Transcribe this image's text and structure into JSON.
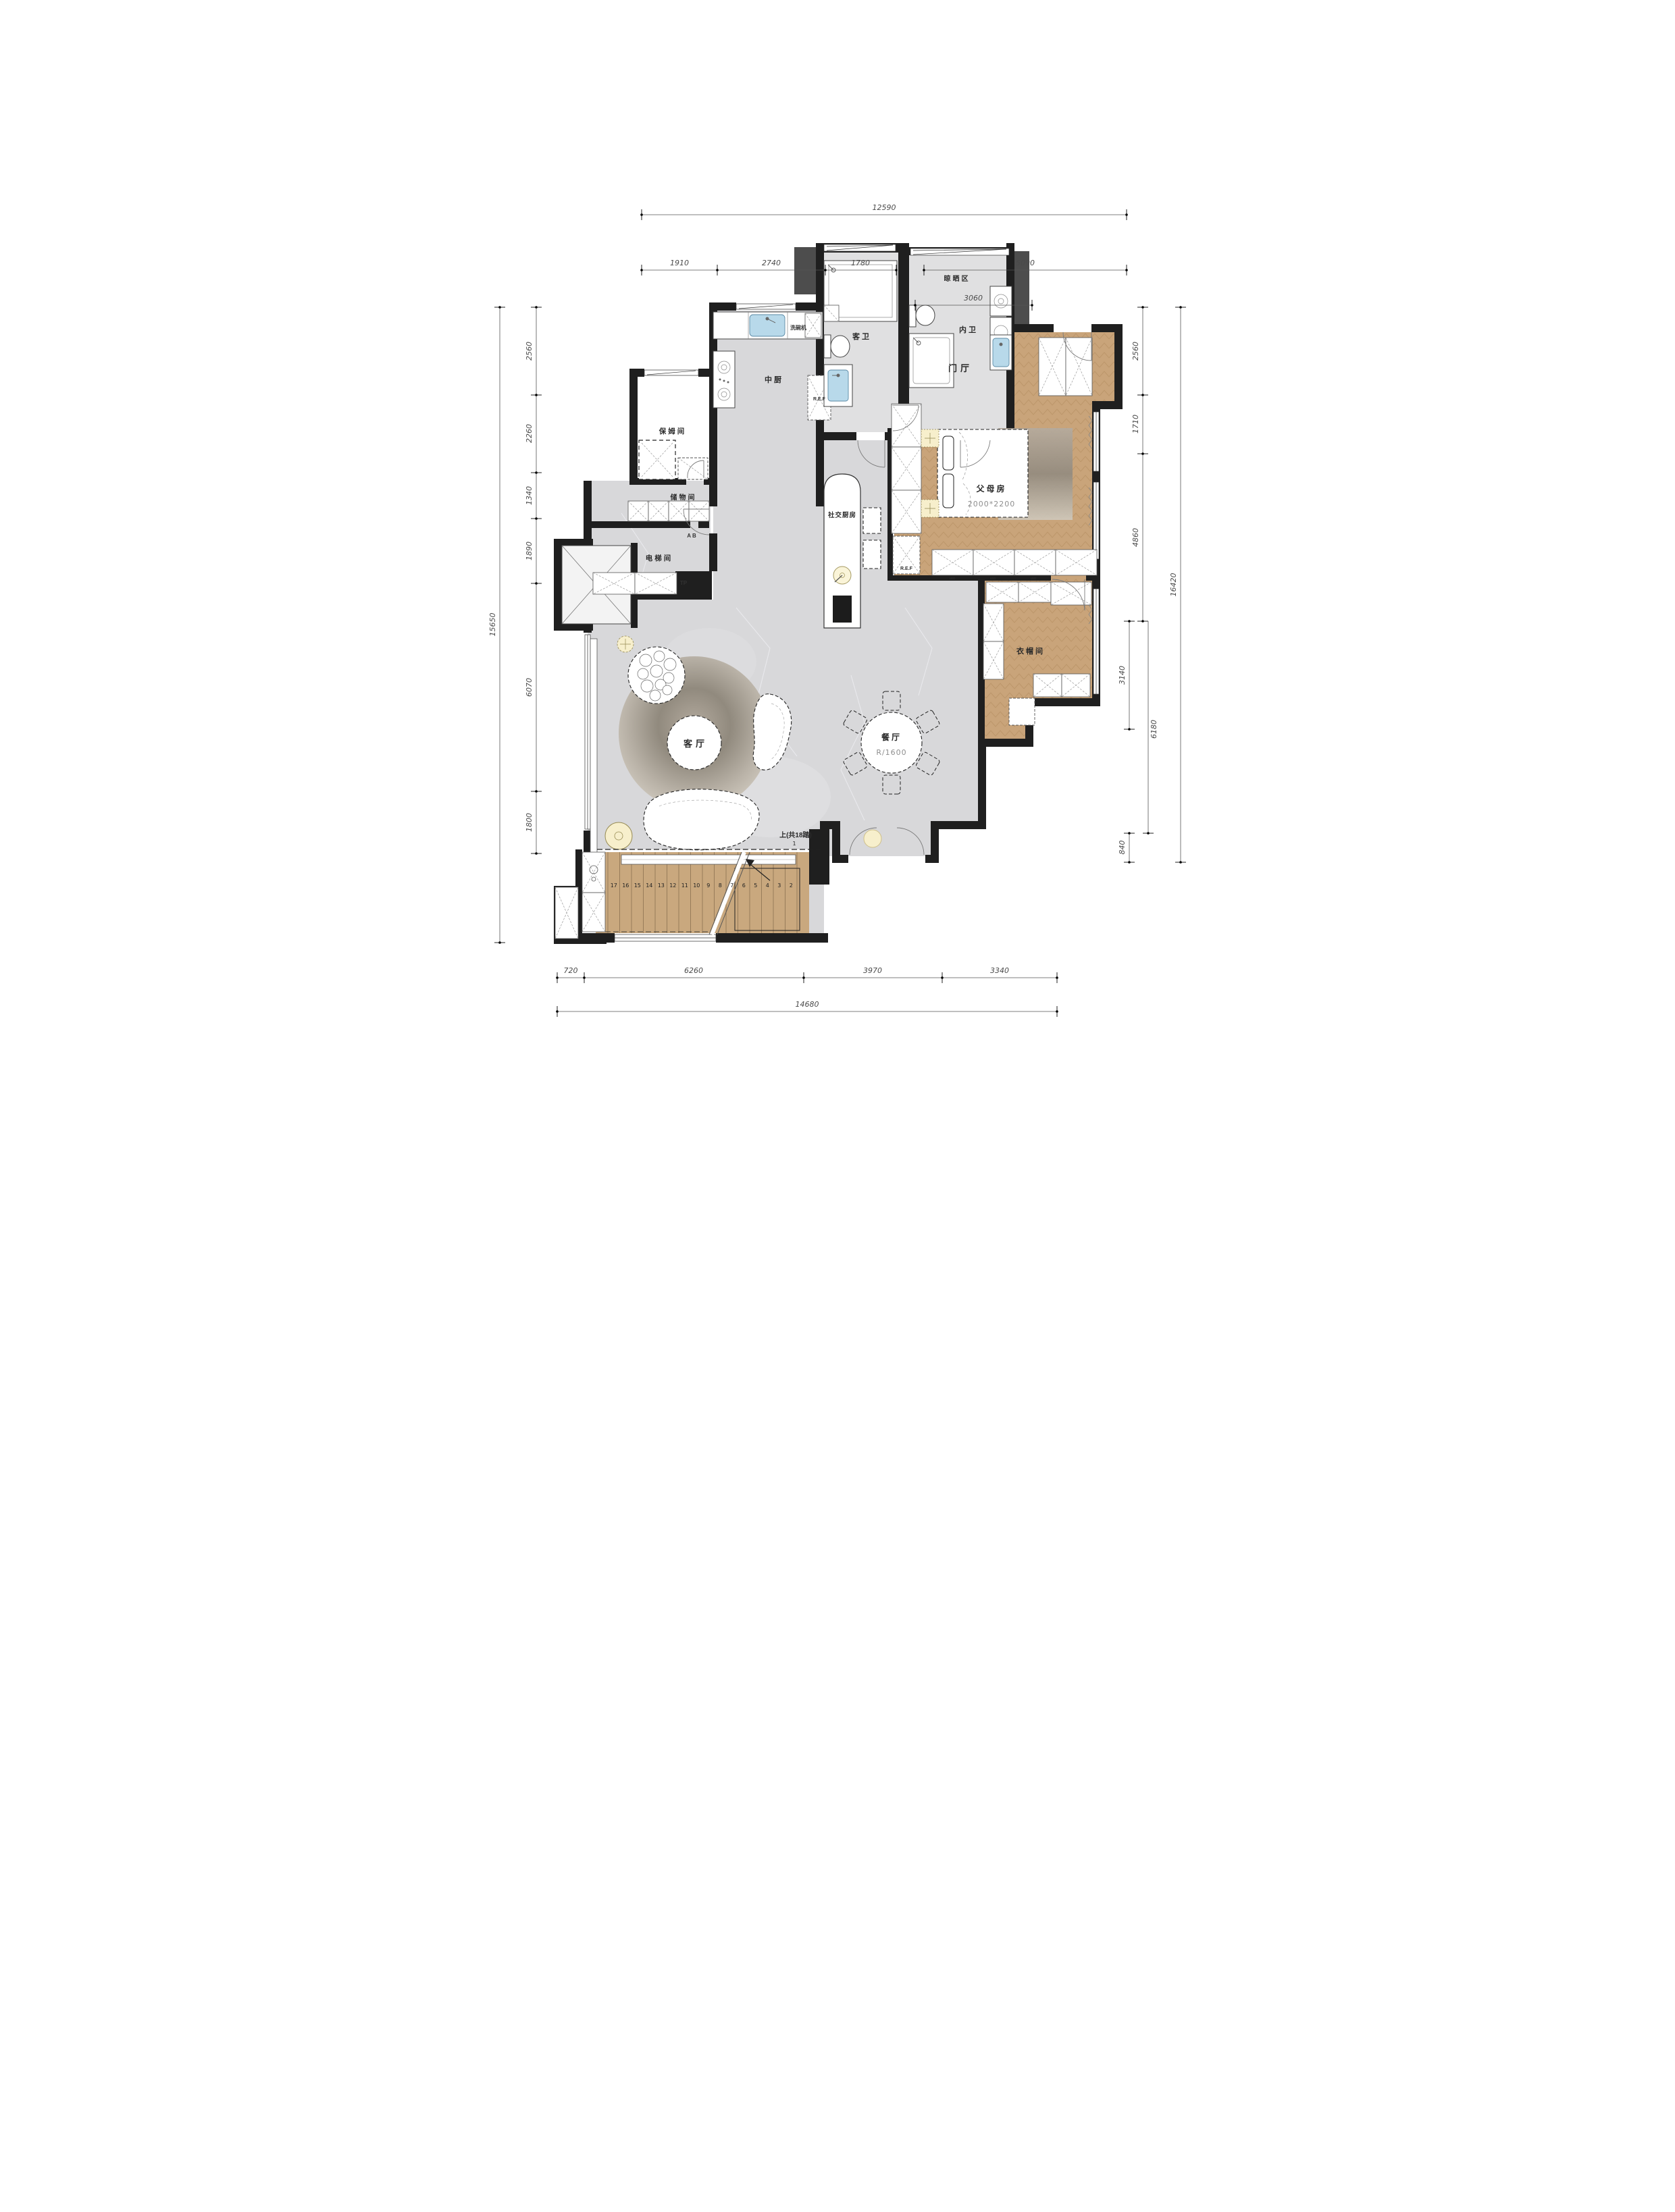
{
  "plan_title": "residential-floor-plan",
  "labels": {
    "guest_bath": "客卫",
    "master_bath": "内卫",
    "drying_area": "晾晒区",
    "kitchen": "中厨",
    "dishwasher": "洗碗机",
    "fridge_kitchen": "R.E.F",
    "fridge_bedroom": "R.E.F",
    "nanny_room": "保姆间",
    "storage_room": "储物间",
    "ab_mark": "A B",
    "elevator_room": "电梯间",
    "tp_mark": "TP",
    "social_kitchen": "社交厨房",
    "foyer": "门厅",
    "parents_room": "父母房",
    "parents_bed_size": "2000*2200",
    "closet_room": "衣帽间",
    "living_room": "客厅",
    "dining_room": "餐厅",
    "dining_table_radius": "R/1600",
    "stairs_note": "上(共18踏)",
    "first_step": "1",
    "led": "LED"
  },
  "stairs": {
    "treads": [
      "17",
      "16",
      "15",
      "14",
      "13",
      "12",
      "11",
      "10",
      "9",
      "8",
      "7",
      "6",
      "5",
      "4",
      "3",
      "2"
    ]
  },
  "dimensions": {
    "top": {
      "overall": "12590",
      "segments": [
        "1910",
        "2740",
        "1780",
        "5090"
      ],
      "sub": "3060"
    },
    "left": {
      "overall": "15650",
      "segments": [
        "2560",
        "2260",
        "1340",
        "1890",
        "6070",
        "1800"
      ]
    },
    "right": {
      "overall": "16420",
      "segments": [
        "2560",
        "1710",
        "4860"
      ],
      "extra": [
        "3140",
        "6180",
        "840"
      ]
    },
    "bottom": {
      "overall": "14680",
      "segments": [
        "720",
        "6260",
        "3970",
        "3340"
      ]
    }
  },
  "colors": {
    "wall": "#1f1f1f",
    "marble_floor": "#d8d8da",
    "bath_floor": "#e0e0e1",
    "wood_floor": "#c9a47a",
    "stairs_wood": "#c9a87e",
    "sink_blue": "#b8d9ea",
    "lamp_yellow": "#f7efcc"
  }
}
